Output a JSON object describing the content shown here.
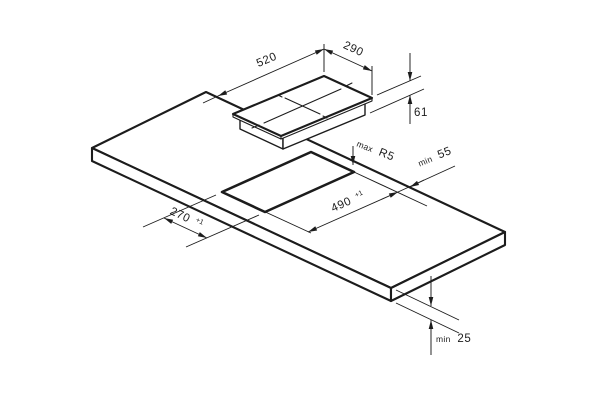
{
  "drawing": {
    "type": "hob-installation-dimension-diagram",
    "colors": {
      "line": "#1c1c1c",
      "background": "#ffffff"
    },
    "labels": {
      "hob_length": {
        "value": "520"
      },
      "hob_depth": {
        "value": "290"
      },
      "hob_height": {
        "value": "61"
      },
      "corner_radius": {
        "prefix": "max",
        "value": "R5"
      },
      "rear_clearance": {
        "prefix": "min",
        "value": "55"
      },
      "cutout_length": {
        "value": "490",
        "tol": "+1"
      },
      "cutout_depth": {
        "value": "270",
        "tol": "+1"
      },
      "worktop_thickness": {
        "prefix": "min",
        "value": "25"
      }
    }
  }
}
